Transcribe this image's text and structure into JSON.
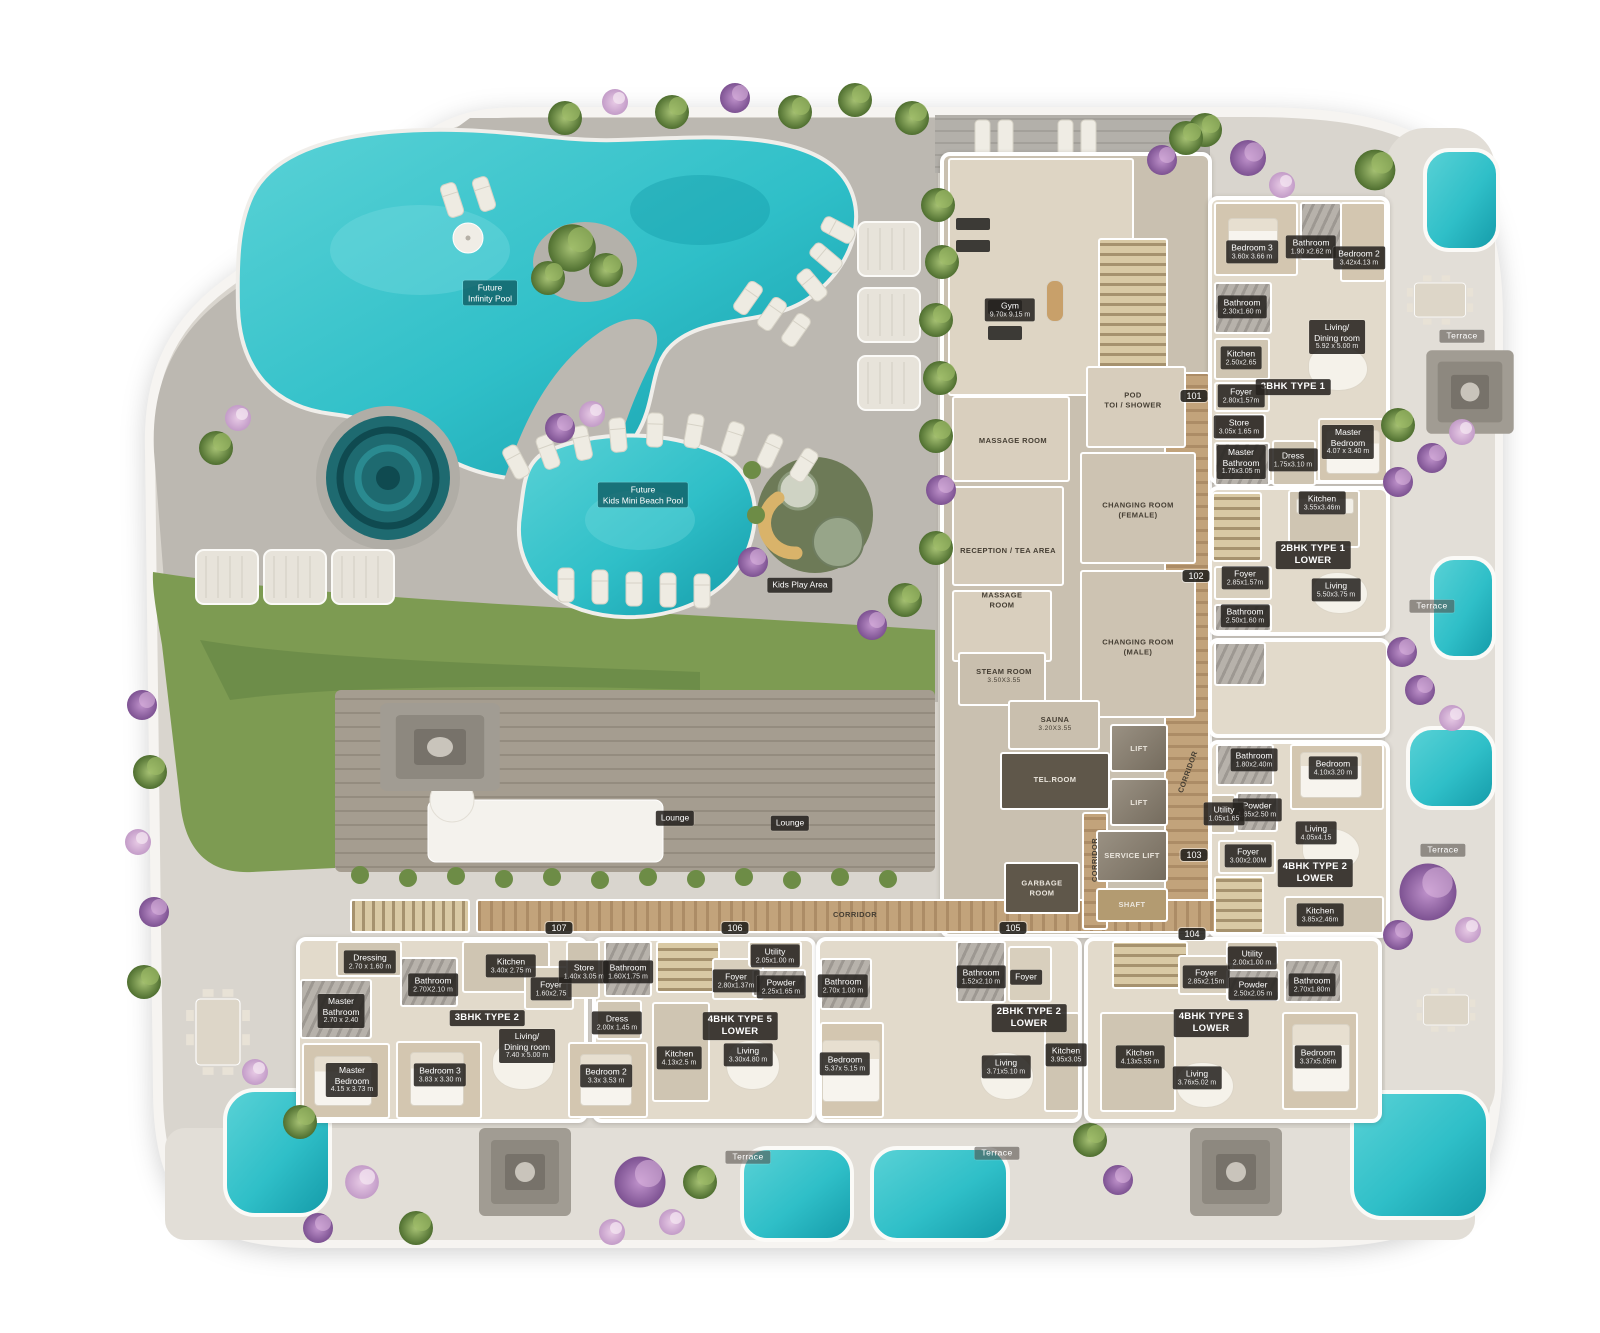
{
  "colors": {
    "water": "#2fbfc8",
    "water_deep": "#149aa8",
    "deck": "#bcb8b1",
    "plate": "#d9d5ce",
    "terrace": "#e2ded7",
    "lawn": "#7d9b52",
    "wood_deck": "#a59d90",
    "corridor_wood": "#c2a37b",
    "unit_floor": "#e2dacb",
    "wall": "#ffffff",
    "chip_bg": "#26231f",
    "pool_label": "#0c565c"
  },
  "pools": {
    "infinity": "Future\nInfinity Pool",
    "kids": "Future\nKids Mini Beach Pool",
    "play": "Kids Play Area"
  },
  "lounge": "Lounge",
  "terrace": "Terrace",
  "corridor": "CORRIDOR",
  "badges": [
    "101",
    "102",
    "103",
    "104",
    "105",
    "106",
    "107"
  ],
  "amenity": {
    "gym": {
      "t": "Gym",
      "d": "9.70x 9.15 m"
    },
    "massage1": {
      "t": "MASSAGE ROOM"
    },
    "pod": {
      "t": "POD\nTOI / SHOWER"
    },
    "reception": {
      "t": "RECEPTION / TEA AREA"
    },
    "massage2": {
      "t": "MASSAGE\nROOM"
    },
    "steam": {
      "t": "STEAM ROOM",
      "d": "3.50X3.55"
    },
    "sauna": {
      "t": "SAUNA",
      "d": "3.20X3.55"
    },
    "changing_f": {
      "t": "CHANGING ROOM\n(FEMALE)"
    },
    "changing_m": {
      "t": "CHANGING ROOM\n(MALE)"
    },
    "tel": {
      "t": "TEL.ROOM"
    },
    "lift": {
      "t": "LIFT"
    },
    "service_lift": {
      "t": "SERVICE LIFT"
    },
    "shaft": {
      "t": "SHAFT"
    },
    "garbage": {
      "t": "GARBAGE\nROOM"
    }
  },
  "units": {
    "u1": {
      "name": "3BHK TYPE 1",
      "rooms": {
        "bedroom3": {
          "t": "Bedroom 3",
          "d": "3.60x 3.66 m"
        },
        "bath1": {
          "t": "Bathroom",
          "d": "1.90 x2.62 m"
        },
        "bedroom2": {
          "t": "Bedroom 2",
          "d": "3.42x4.13 m"
        },
        "bath2": {
          "t": "Bathroom",
          "d": "2.30x1.60 m"
        },
        "living": {
          "t": "Living/\nDining room",
          "d": "5.92 x 5.00 m"
        },
        "kitchen": {
          "t": "Kitchen",
          "d": "2.50x2.65"
        },
        "foyer": {
          "t": "Foyer",
          "d": "2.80x1.57m"
        },
        "store": {
          "t": "Store",
          "d": "3.05x 1.65 m"
        },
        "master_bath": {
          "t": "Master\nBathroom",
          "d": "1.75x3.05 m"
        },
        "dress": {
          "t": "Dress",
          "d": "1.75x3.10 m"
        },
        "master_bed": {
          "t": "Master\nBedroom",
          "d": "4.07 x 3.40 m"
        }
      }
    },
    "u2": {
      "name": "2BHK TYPE 1\nLOWER",
      "rooms": {
        "kitchen": {
          "t": "Kitchen",
          "d": "3.55x3.46m"
        },
        "foyer": {
          "t": "Foyer",
          "d": "2.85x1.57m"
        },
        "living": {
          "t": "Living",
          "d": "5.50x3.75 m"
        },
        "bath": {
          "t": "Bathroom",
          "d": "2.50x1.60 m"
        }
      }
    },
    "u3": {
      "name": "4BHK TYPE 2\nLOWER",
      "rooms": {
        "bath": {
          "t": "Bathroom",
          "d": "1.80x2.40m"
        },
        "bedroom": {
          "t": "Bedroom",
          "d": "4.10x3.20 m"
        },
        "powder": {
          "t": "Powder",
          "d": "1.65x2.50 m"
        },
        "utility": {
          "t": "Utility",
          "d": "1.05x1.65"
        },
        "foyer": {
          "t": "Foyer",
          "d": "3.00x2.00M"
        },
        "living": {
          "t": "Living",
          "d": "4.05x4.15"
        },
        "kitchen": {
          "t": "Kitchen",
          "d": "3.85x2.46m"
        }
      }
    },
    "u4": {
      "name": "3BHK TYPE 2",
      "rooms": {
        "dressing": {
          "t": "Dressing",
          "d": "2.70 x 1.60 m"
        },
        "kitchen": {
          "t": "Kitchen",
          "d": "3.40x 2.75 m"
        },
        "bath": {
          "t": "Bathroom",
          "d": "2.70X2.10 m"
        },
        "foyer": {
          "t": "Foyer",
          "d": "1.60x2.75"
        },
        "master_bath": {
          "t": "Master\nBathroom",
          "d": "2.70 x 2.40"
        },
        "living": {
          "t": "Living/\nDining room",
          "d": "7.40 x 5.00 m"
        },
        "master_bed": {
          "t": "Master\nBedroom",
          "d": "4.15 x 3.73 m"
        },
        "bedroom3": {
          "t": "Bedroom 3",
          "d": "3.83 x 3.30 m"
        }
      }
    },
    "u5": {
      "name": "4BHK TYPE 5\nLOWER",
      "rooms": {
        "store": {
          "t": "Store",
          "d": "1.40x 3.05 m"
        },
        "bath1": {
          "t": "Bathroom",
          "d": "1.60X1.75 m"
        },
        "foyer": {
          "t": "Foyer",
          "d": "2.80x1.37m"
        },
        "utility": {
          "t": "Utility",
          "d": "2.05x1.00 m"
        },
        "powder": {
          "t": "Powder",
          "d": "2.25x1.65 m"
        },
        "dress": {
          "t": "Dress",
          "d": "2.00x 1.45 m"
        },
        "kitchen": {
          "t": "Kitchen",
          "d": "4.13x2.5 m"
        },
        "living": {
          "t": "Living",
          "d": "3.30x4.80 m"
        },
        "bedroom2": {
          "t": "Bedroom 2",
          "d": "3.3x 3.53 m"
        }
      }
    },
    "u6": {
      "name": "2BHK TYPE 2\nLOWER",
      "rooms": {
        "bath": {
          "t": "Bathroom",
          "d": "2.70x 1.00 m"
        },
        "bedroom": {
          "t": "Bedroom",
          "d": "5.37x 5.15 m"
        },
        "bath2": {
          "t": "Bathroom",
          "d": "1.52x2.10 m"
        },
        "foyer": {
          "t": "Foyer"
        },
        "living": {
          "t": "Living",
          "d": "3.71x5.10 m"
        },
        "kitchen": {
          "t": "Kitchen",
          "d": "3.95x3.05"
        }
      }
    },
    "u7": {
      "name": "4BHK TYPE 3\nLOWER",
      "rooms": {
        "foyer": {
          "t": "Foyer",
          "d": "2.85x2.15m"
        },
        "utility": {
          "t": "Utility",
          "d": "2.00x1.00 m"
        },
        "powder": {
          "t": "Powder",
          "d": "2.50x2.05 m"
        },
        "bath": {
          "t": "Bathroom",
          "d": "2.70x1.80m"
        },
        "kitchen": {
          "t": "Kitchen",
          "d": "4.13x5.55 m"
        },
        "living": {
          "t": "Living",
          "d": "3.76x5.02 m"
        },
        "bedroom": {
          "t": "Bedroom",
          "d": "3.37x5.05m"
        }
      }
    }
  }
}
